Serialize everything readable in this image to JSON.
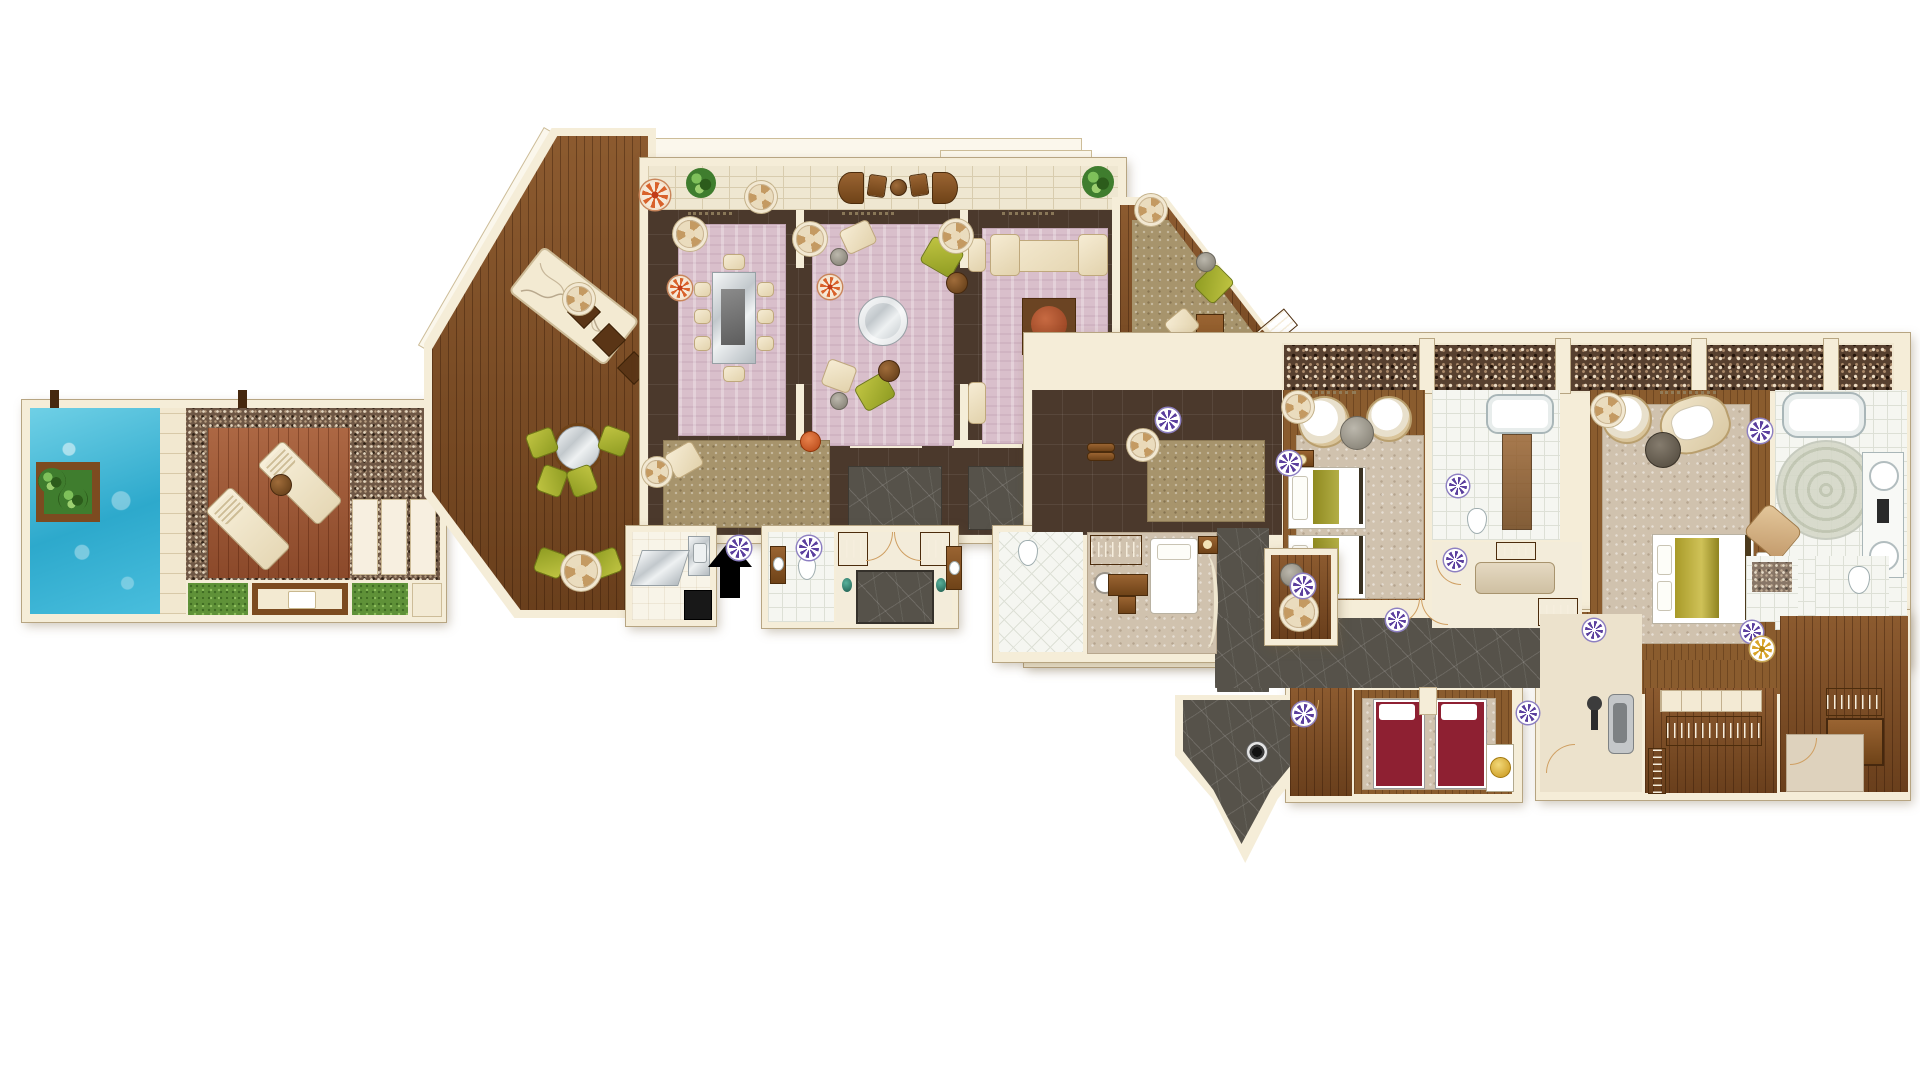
{
  "meta": {
    "type": "architectural-floor-plan",
    "description": "Top-view illustrated floor plan of a luxury villa suite with private pool terrace, three lounge rooms, study, two guest bedrooms with bathrooms, staff quarters, spa room, gym and dressing rooms",
    "text_labels_visible": false
  },
  "palette": {
    "background": "#ffffff",
    "wall-cream": "#f5edd8",
    "wall-outline": "#b7a582",
    "pool-blue": "#3cb6d8",
    "pebble-brown": "#6e5745",
    "mosaic-brown": "#57402f",
    "deck-red-wood": "#9e5330",
    "interior-wood": "#7c4a21",
    "dark-floor-tile": "#4b392c",
    "slate-gray": "#56524a",
    "white-tile": "#f5f6f1",
    "carpet-pink": "#d9bfcb",
    "carpet-beige": "#d0c2ae",
    "carpet-tan": "#a7946c",
    "grass-green": "#5f9138",
    "furniture-cream": "#efe3c8",
    "furniture-olive": "#9fa82c",
    "furniture-brown": "#7a4a21",
    "spa-bed-red": "#8e2032",
    "accent-gold": "#d9a52b",
    "medallion-purple": "#5b3f9e",
    "medallion-orange": "#d9622b",
    "terracotta": "#a8522e",
    "entry-arrow-black": "#000000"
  },
  "areas": [
    {
      "name": "pool-terrace",
      "features": [
        "swimming-pool",
        "planter-island",
        "sun-deck",
        "two-sun-loungers",
        "drinks-table",
        "pebble-paving",
        "lawn-patches",
        "cabana-daybed",
        "stone-slab-patio",
        "timber-posts"
      ]
    },
    {
      "name": "veranda-deck",
      "features": [
        "decorative-inlay-panel",
        "four-floor-cushions",
        "round-mirror-table",
        "six-olive-armchairs",
        "fan-side-table"
      ]
    },
    {
      "name": "balcony-terrace",
      "features": [
        "brick-paving",
        "curved-lounge-seats",
        "planter-shrubs"
      ]
    },
    {
      "name": "dining-room",
      "features": [
        "mirror-top-dining-table",
        "eight-dining-chairs",
        "pink-carpet"
      ]
    },
    {
      "name": "living-room",
      "features": [
        "round-glass-table",
        "two-olive-armchairs",
        "two-cream-armchairs",
        "round-side-tables",
        "pink-carpet"
      ]
    },
    {
      "name": "family-room",
      "features": [
        "large-cream-sofa",
        "two-side-seats",
        "square-rug",
        "round-terracotta-table",
        "pink-carpet"
      ]
    },
    {
      "name": "study",
      "features": [
        "desk",
        "two-guest-chairs",
        "olive-desk-chair",
        "slatted-bookshelf",
        "tan-carpet"
      ]
    },
    {
      "name": "majlis-lounge",
      "features": [
        "speckled-area-rug",
        "floor-cushion",
        "orange-pouf"
      ]
    },
    {
      "name": "kitchenette",
      "features": [
        "sink-unit",
        "black-range",
        "mirror-panel"
      ]
    },
    {
      "name": "guest-bathroom",
      "features": [
        "wc",
        "vanity-basin",
        "white-tile-floor"
      ]
    },
    {
      "name": "entrance-foyer",
      "features": [
        "double-entry-door",
        "two-hanger-closets",
        "slate-door-mat",
        "two-teal-urns"
      ]
    },
    {
      "name": "mosaic-terrace",
      "features": [
        "pebble-mosaic-paving",
        "cream-pillars"
      ]
    },
    {
      "name": "hallway",
      "features": [
        "dark-tile-floor",
        "slate-rugs",
        "rolled-towels"
      ]
    },
    {
      "name": "twin-bedroom",
      "features": [
        "two-twin-beds",
        "nightstand-with-lamp",
        "two-papasan-chairs",
        "round-gray-table",
        "beige-carpet"
      ]
    },
    {
      "name": "twin-bathroom",
      "features": [
        "bathtub",
        "wc",
        "brown-runner-rug",
        "white-tile-floor"
      ]
    },
    {
      "name": "dressing-room-one",
      "features": [
        "island-bench",
        "hanging-rails",
        "doors"
      ]
    },
    {
      "name": "master-bedroom",
      "features": [
        "king-bed-gold-duvet",
        "foot-bench",
        "papasan-chair",
        "lounge-chair",
        "dark-round-table",
        "beige-carpet"
      ]
    },
    {
      "name": "master-bathroom",
      "features": [
        "bathtub",
        "double-sink-vanity",
        "circular-mosaic-floor-medallion",
        "tan-ottoman",
        "pebble-shower",
        "wc-closet"
      ]
    },
    {
      "name": "staff-room",
      "features": [
        "single-bed",
        "desk-and-chair",
        "hanger-closet",
        "curved-partition",
        "en-suite-wc-shower"
      ]
    },
    {
      "name": "wet-bar-pantry",
      "features": [
        "cabinet",
        "round-appliance"
      ]
    },
    {
      "name": "spa-treatment-room",
      "features": [
        "two-red-massage-beds",
        "gold-basin-unit",
        "beige-rug"
      ]
    },
    {
      "name": "gym-corner",
      "features": [
        "treadmill",
        "exercise-equipment"
      ]
    },
    {
      "name": "walk-in-closet",
      "features": [
        "shelf-band",
        "hanging-rails-with-hangers"
      ]
    },
    {
      "name": "luggage-dressing-room",
      "features": [
        "hanging-rail",
        "wardrobe",
        "door"
      ]
    },
    {
      "name": "service-corridors",
      "features": [
        "slate-flooring",
        "zigzag-exit-ramp",
        "double-doors"
      ]
    }
  ],
  "symbols": {
    "entry_arrow": {
      "direction": "up",
      "color": "#000000"
    },
    "ceiling_fan_medallions": 9,
    "purple_rosette_medallions": 13,
    "orange_rosette_medallions": 3,
    "gold_rosette_medallions": 1,
    "dark_spot_medallions": 1
  }
}
